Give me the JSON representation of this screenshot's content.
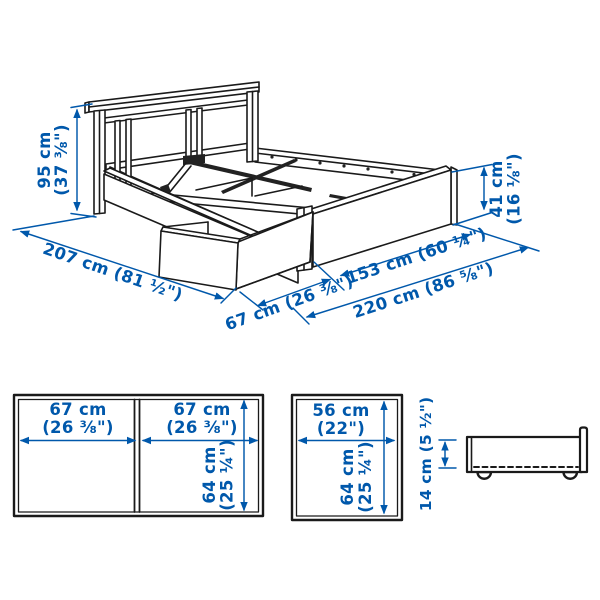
{
  "colors": {
    "dimension_blue": "#0058AB",
    "outline": "#1a1a1a",
    "background": "#ffffff",
    "metal_brace": "#222222"
  },
  "main_view": {
    "bed_height": {
      "metric": "95 cm",
      "imperial": "(37 ⅜\")"
    },
    "bed_width": {
      "label": "207 cm (81 ½\")"
    },
    "drawer_extension": {
      "label": "67 cm (26 ⅜\")"
    },
    "foot_end_width": {
      "label": "153 cm (60 ¼\")"
    },
    "bed_length": {
      "label": "220 cm (86 ⅝\")"
    },
    "footboard_height": {
      "metric": "41 cm",
      "imperial": "(16 ⅛\")"
    }
  },
  "drawer_pair_front_view": {
    "left_drawer_width": {
      "metric": "67 cm",
      "imperial": "(26 ⅜\")"
    },
    "right_drawer_width": {
      "metric": "67 cm",
      "imperial": "(26 ⅜\")"
    },
    "drawer_height": {
      "metric": "64 cm",
      "imperial": "(25 ¼\")"
    }
  },
  "single_drawer_front_view": {
    "drawer_width": {
      "metric": "56 cm",
      "imperial": "(22\")"
    },
    "drawer_height": {
      "metric": "64 cm",
      "imperial": "(25 ¼\")"
    }
  },
  "drawer_side_view": {
    "drawer_side_height": {
      "label": "14 cm (5 ½\")"
    }
  }
}
